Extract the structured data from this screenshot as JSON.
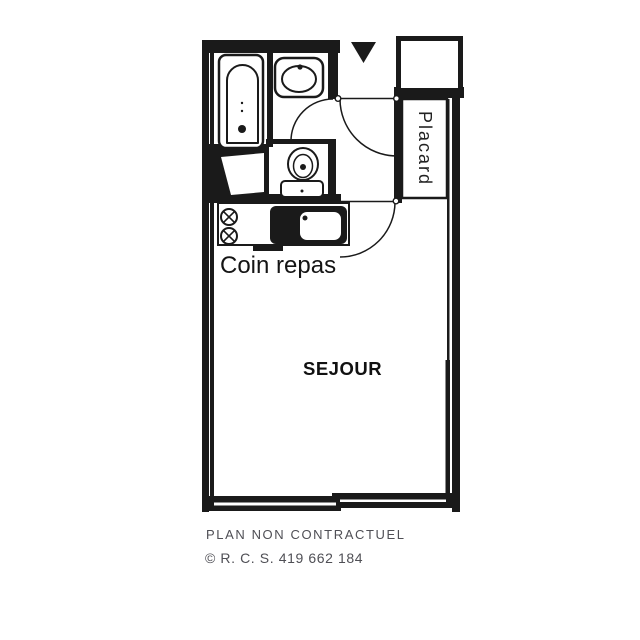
{
  "page": {
    "background_color": "#ffffff"
  },
  "plan": {
    "ink_color": "#1a1a1a",
    "rooms": {
      "closet_label": "Placard",
      "dining_label": "Coin repas",
      "living_label": "SEJOUR"
    },
    "fixtures": [
      "bathtub",
      "washbasin",
      "toilet",
      "hotplates",
      "kitchen-sink",
      "closet",
      "entrance-arrow",
      "door-swings",
      "window-wall"
    ]
  },
  "footer": {
    "disclaimer": "PLAN NON CONTRACTUEL",
    "registration": "© R. C. S. 419 662 184",
    "text_color": "#4f4f55"
  }
}
